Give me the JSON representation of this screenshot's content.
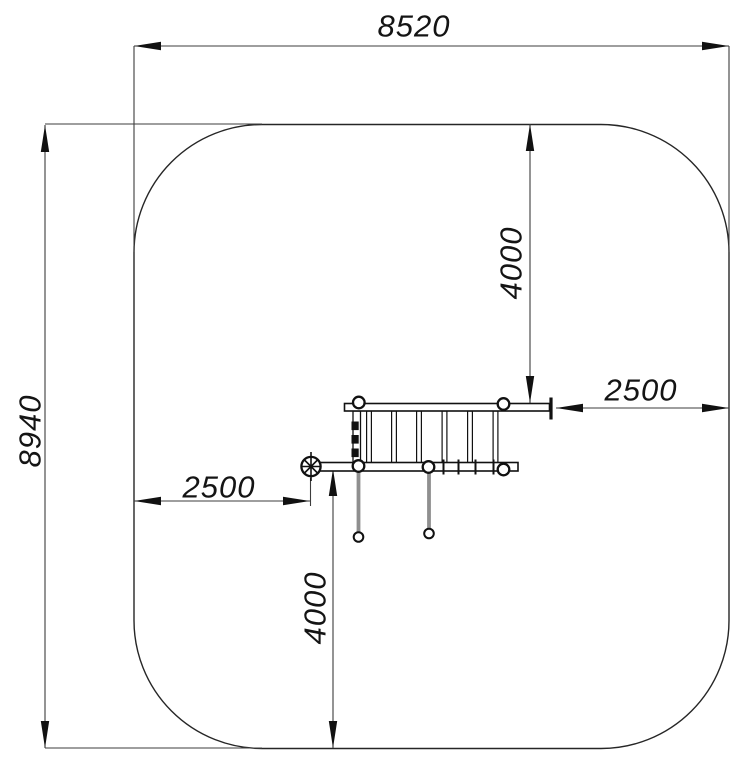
{
  "drawing": {
    "title": "playground-equipment-safety-zone-plan",
    "units": "mm",
    "colors": {
      "background": "#ffffff",
      "outline": "#1f1f1f",
      "dimension_line": "#3d3d3d",
      "post_gray": "#8f8f8f"
    },
    "dims": {
      "overall_width": "8520",
      "overall_height": "8940",
      "clearance_top": "4000",
      "clearance_right": "2500",
      "clearance_left": "2500",
      "clearance_bottom": "4000"
    }
  }
}
